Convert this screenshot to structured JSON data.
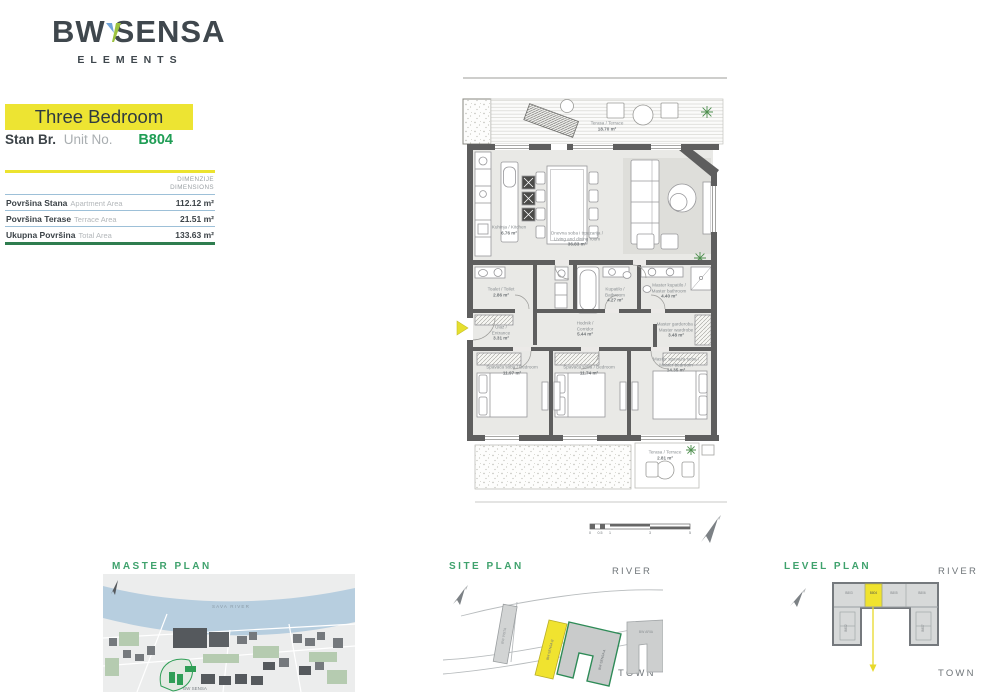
{
  "brand": {
    "logo_primary": "BW",
    "logo_secondary": "SENSA",
    "logo_sub": "ELEMENTS"
  },
  "unit": {
    "type_title": "Three Bedroom",
    "label_sr": "Stan Br.",
    "label_en": "Unit No.",
    "number": "B804"
  },
  "dimensions_table": {
    "header_sr": "DIMENZIJE",
    "header_en": "DIMENSIONS",
    "rows": [
      {
        "name_sr": "Površina Stana",
        "name_en": "Apartment Area",
        "value": "112.12 m²"
      },
      {
        "name_sr": "Površina Terase",
        "name_en": "Terrace Area",
        "value": "21.51 m²"
      },
      {
        "name_sr": "Ukupna Površina",
        "name_en": "Total Area",
        "value": "133.63 m²"
      }
    ]
  },
  "floor_plan": {
    "rooms": {
      "terrace_main": {
        "name": "Terasa / Terrace",
        "area": "18.70 m²"
      },
      "kitchen": {
        "name": "Kuhinja / Kitchen",
        "area": "6.76 m²"
      },
      "living": {
        "name": "Dnevna soba i trpezarija / Living and dining room",
        "area": "36.83 m²"
      },
      "toilet": {
        "name": "Toalet / Toilet",
        "area": "2.86 m²"
      },
      "bathroom": {
        "name": "Kupatilo / Bathroom",
        "area": "4.27 m²"
      },
      "master_bath": {
        "name": "Master kupatilo / Master bathroom",
        "area": "4.40 m²"
      },
      "entrance": {
        "name": "Ulaz / Entrance",
        "area": "3.31 m²"
      },
      "corridor": {
        "name": "Hodnik / Corridor",
        "area": "5.44 m²"
      },
      "master_wardrobe": {
        "name": "Master garderoba / Master wardrobe",
        "area": "3.48 m²"
      },
      "bedroom1": {
        "name": "Spavaća soba / Bedroom",
        "area": "11.97 m²"
      },
      "bedroom2": {
        "name": "Spavaća soba / Bedroom",
        "area": "11.74 m²"
      },
      "master_bedroom": {
        "name": "Master spavaća soba / Master bedroom",
        "area": "14.35 m²"
      },
      "terrace_small": {
        "name": "Terasa / Terrace",
        "area": "2.81 m²"
      }
    },
    "scale_ticks": [
      "0",
      "0.5",
      "1",
      "3",
      "5"
    ]
  },
  "mini_plans": {
    "master": {
      "title": "MASTER PLAN",
      "river_label": "SAVA RIVER",
      "project_label": "BW SENSA"
    },
    "site": {
      "title": "SITE PLAN",
      "river": "RIVER",
      "town": "TOWN",
      "building_left": "BW VISTA",
      "building_yellow": "BW SENSA B",
      "building_green": "BW SENSA A",
      "building_right": "BW ARIA"
    },
    "level": {
      "title": "LEVEL PLAN",
      "river": "RIVER",
      "town": "TOWN",
      "unit_highlight": "B804",
      "units": [
        "B803",
        "B805",
        "B806",
        "B802",
        "B807"
      ]
    }
  },
  "colors": {
    "accent_yellow": "#ede432",
    "accent_green": "#2e7d4f",
    "unit_green": "#1f9d55",
    "table_blue": "#9dc0d8"
  }
}
